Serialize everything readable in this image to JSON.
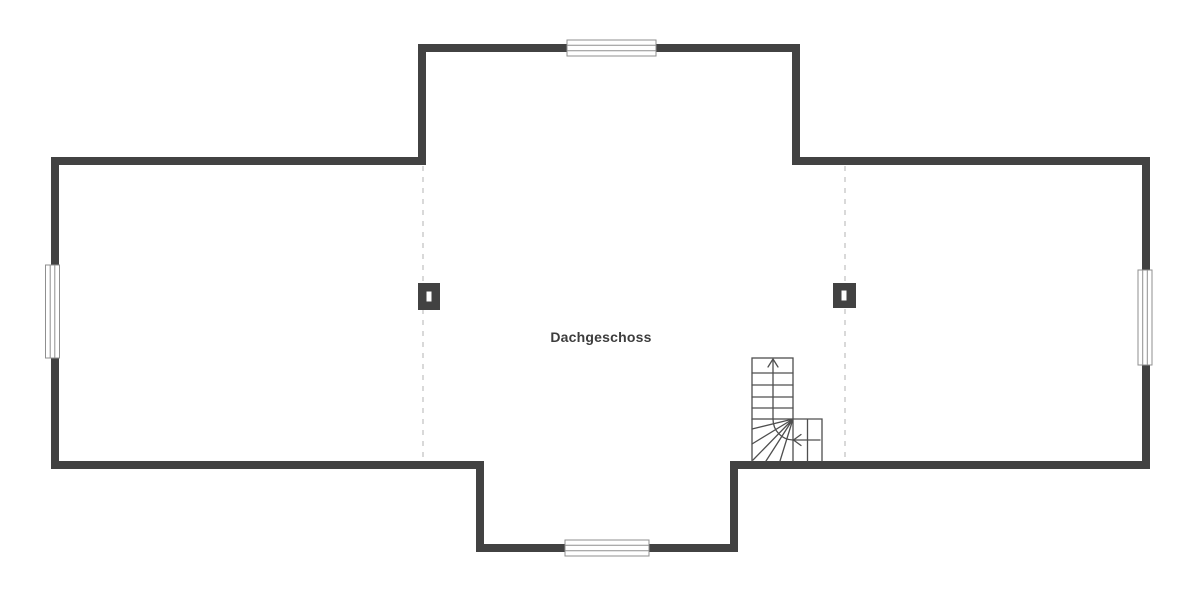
{
  "floor_plan": {
    "label": "Dachgeschoss",
    "colors": {
      "wall": "#424242",
      "stair_line": "#4f4f4f",
      "dashed_line": "#d9d9d9",
      "window_border": "#8f8f8f",
      "window_fill": "#ffffff",
      "label_text": "#3d3d3d"
    },
    "symbols": {
      "windows": [
        "window-north",
        "window-west",
        "window-east",
        "window-south"
      ],
      "chimneys": [
        "chimney-left",
        "chimney-right"
      ],
      "staircase": {
        "type": "l-shaped-winder-stair",
        "direction_arrow": "up"
      },
      "dashed_lines": [
        "section-divider-left",
        "section-divider-right"
      ]
    }
  }
}
